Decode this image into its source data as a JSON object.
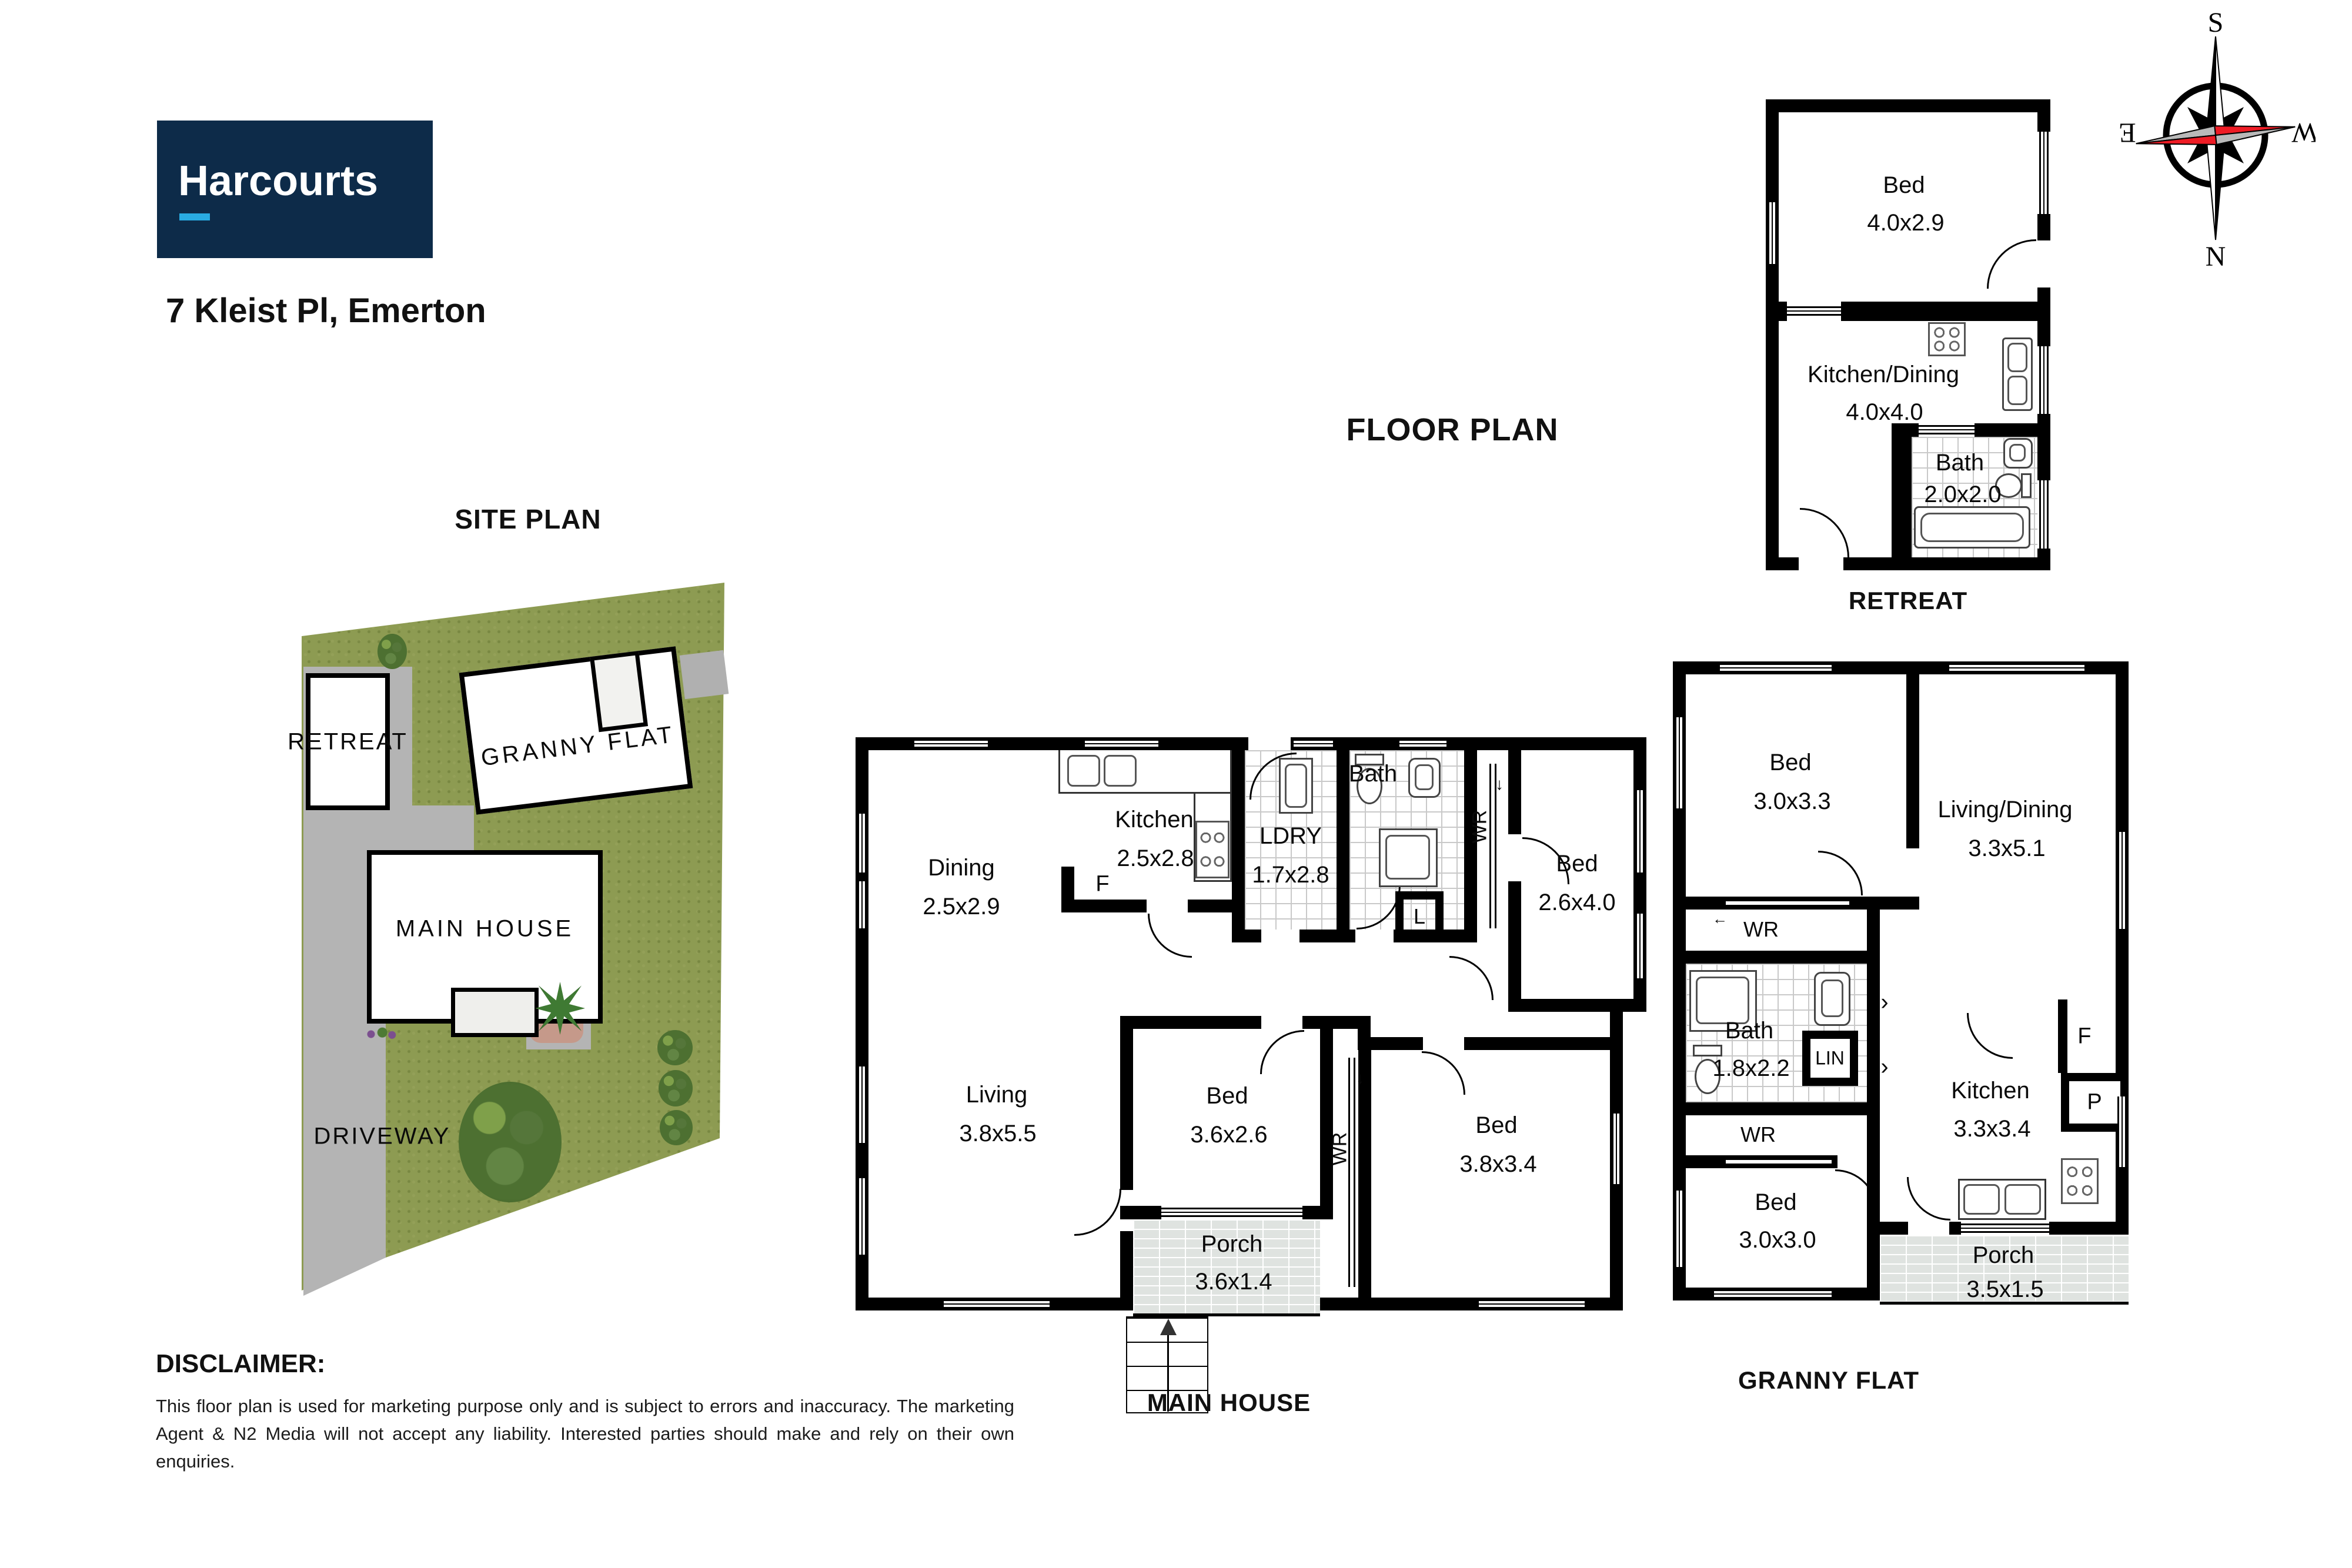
{
  "header": {
    "logo": "Harcourts",
    "address": "7 Kleist Pl, Emerton"
  },
  "titles": {
    "floor_plan": "FLOOR PLAN",
    "site_plan": "SITE PLAN"
  },
  "compass": {
    "n": "N",
    "s": "S",
    "e": "E",
    "w": "W"
  },
  "site": {
    "retreat": "RETREAT",
    "granny_flat": "GRANNY FLAT",
    "main_house": "MAIN HOUSE",
    "driveway": "DRIVEWAY"
  },
  "plans": {
    "retreat": {
      "title": "RETREAT",
      "bed": {
        "label": "Bed",
        "dims": "4.0x2.9"
      },
      "kitchen_dining": {
        "label": "Kitchen/Dining",
        "dims": "4.0x4.0"
      },
      "bath": {
        "label": "Bath",
        "dims": "2.0x2.0"
      }
    },
    "main": {
      "title": "MAIN HOUSE",
      "dining": {
        "label": "Dining",
        "dims": "2.5x2.9"
      },
      "kitchen": {
        "label": "Kitchen",
        "dims": "2.5x2.8"
      },
      "ldry": {
        "label": "LDRY",
        "dims": "1.7x2.8"
      },
      "bath": {
        "label": "Bath"
      },
      "bed1": {
        "label": "Bed",
        "dims": "2.6x4.0"
      },
      "living": {
        "label": "Living",
        "dims": "3.8x5.5"
      },
      "bed2": {
        "label": "Bed",
        "dims": "3.6x2.6"
      },
      "bed3": {
        "label": "Bed",
        "dims": "3.8x3.4"
      },
      "porch": {
        "label": "Porch",
        "dims": "3.6x1.4"
      },
      "wr_top": "WR",
      "wr_bottom": "WR",
      "linen": "L",
      "fridge": "F"
    },
    "granny": {
      "title": "GRANNY FLAT",
      "bed1": {
        "label": "Bed",
        "dims": "3.0x3.3"
      },
      "living_dining": {
        "label": "Living/Dining",
        "dims": "3.3x5.1"
      },
      "bath": {
        "label": "Bath",
        "dims": "1.8x2.2"
      },
      "bed2": {
        "label": "Bed",
        "dims": "3.0x3.0"
      },
      "kitchen": {
        "label": "Kitchen",
        "dims": "3.3x3.4"
      },
      "porch": {
        "label": "Porch",
        "dims": "3.5x1.5"
      },
      "wr1": "WR",
      "wr2": "WR",
      "lin": "LIN",
      "fridge": "F",
      "pantry": "P"
    }
  },
  "disclaimer": {
    "heading": "DISCLAIMER:",
    "body": "This floor plan is used for marketing purpose only and is subject to errors and inaccuracy. The marketing Agent & N2 Media will not accept any liability. Interested parties should make and rely on their own enquiries."
  },
  "colors": {
    "navy": "#0d2b49",
    "cyan": "#29abe2",
    "grass": "#8d9b52",
    "driveway": "#b4b4b4",
    "needle_red": "#ee1c25"
  }
}
